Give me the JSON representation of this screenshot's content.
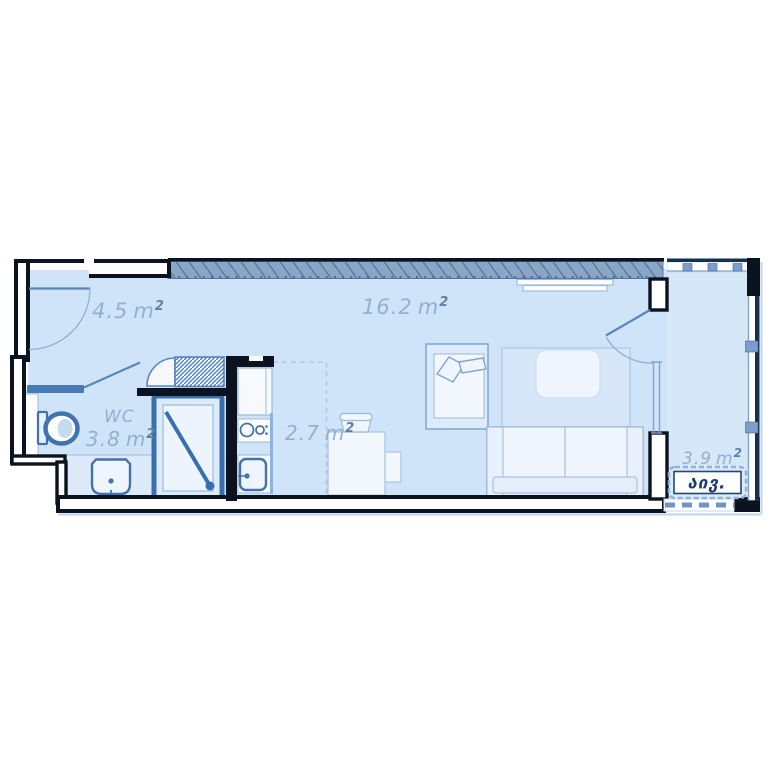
{
  "plan": {
    "type": "apartment-floor-plan",
    "rooms": {
      "hallway": {
        "area": "4.5",
        "unit": "m",
        "sup": "2"
      },
      "living_room": {
        "area": "16.2",
        "unit": "m",
        "sup": "2"
      },
      "wc": {
        "name": "WC",
        "area": "3.8",
        "unit": "m",
        "sup": "2"
      },
      "kitchen": {
        "area": "2.7",
        "unit": "m",
        "sup": "2"
      },
      "balcony": {
        "area": "3.9",
        "unit": "m",
        "sup": "2",
        "tag": "აივ."
      }
    },
    "colors": {
      "wall": "#0c1320",
      "floor": "#cfe4f8",
      "balcony_floor": "#d6e7f8",
      "fixture_stroke": "#4273ad",
      "furniture_stroke": "#9db8da",
      "hatch_band": "#8ba6c5",
      "label": "#93afd2",
      "tag_text": "#1d3f6e",
      "glazing": "#7fa3cc",
      "partition_blue": "#4a7ab5"
    },
    "symbols": [
      "entry-door",
      "wc-door",
      "balcony-door",
      "wardrobe",
      "shower",
      "toilet",
      "washbasin",
      "fridge",
      "stove",
      "kitchen-sink",
      "desk",
      "chair",
      "bed",
      "rug",
      "coffee-table",
      "sofa",
      "radiator",
      "window"
    ]
  }
}
